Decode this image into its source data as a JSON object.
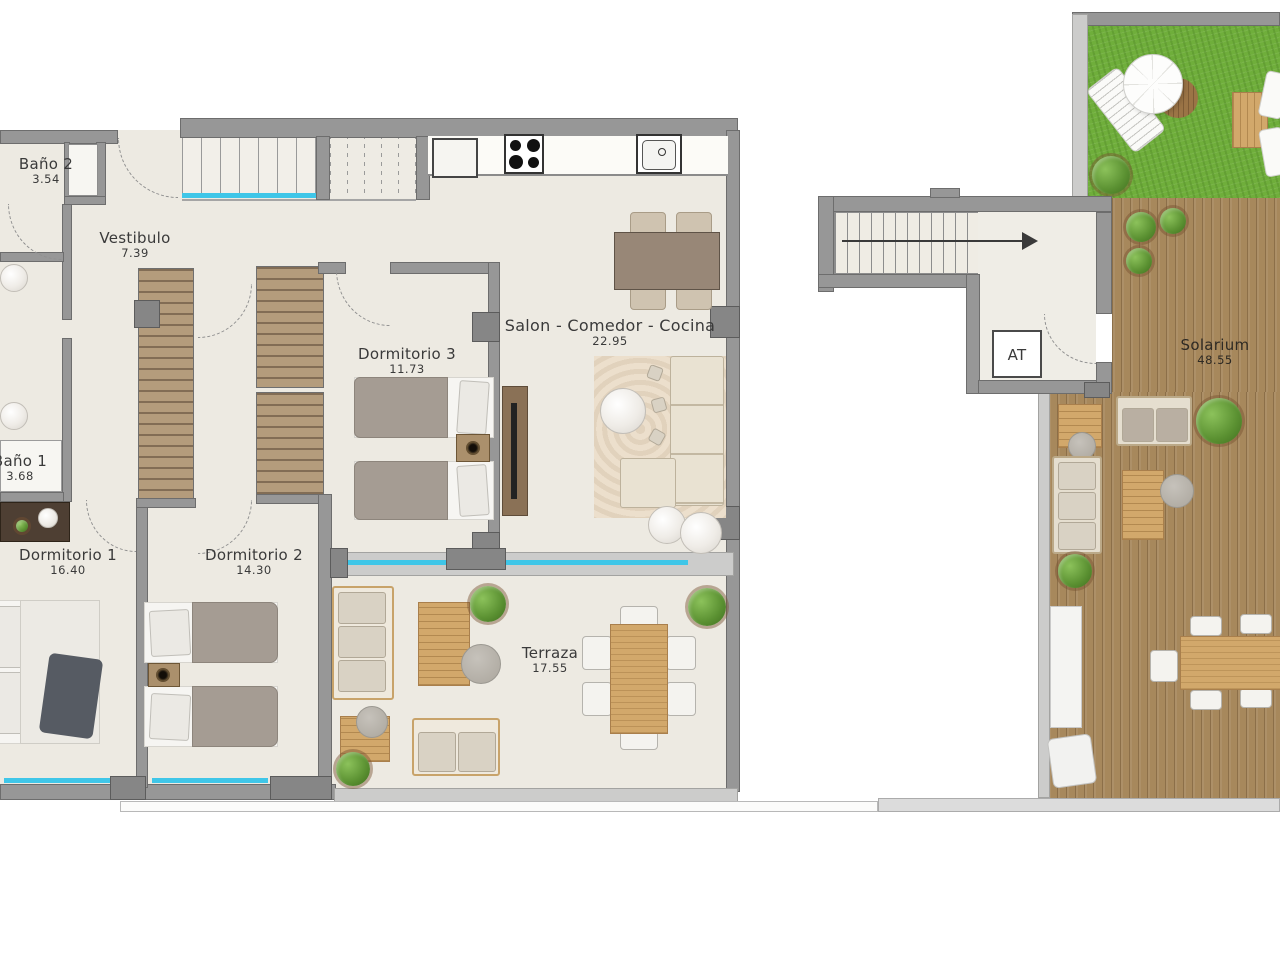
{
  "rooms": {
    "bano2": {
      "name": "Baño 2",
      "area": "3.54"
    },
    "vestibulo": {
      "name": "Vestibulo",
      "area": "7.39"
    },
    "dormitorio3": {
      "name": "Dormitorio 3",
      "area": "11.73"
    },
    "salon_comedor_cocina": {
      "name": "Salon - Comedor - Cocina",
      "area": "22.95"
    },
    "bano1": {
      "name": "Baño 1",
      "area": "3.68"
    },
    "dormitorio1": {
      "name": "Dormitorio 1",
      "area": "16.40"
    },
    "dormitorio2": {
      "name": "Dormitorio 2",
      "area": "14.30"
    },
    "terraza": {
      "name": "Terraza",
      "area": "17.55"
    },
    "solarium": {
      "name": "Solarium",
      "area": "48.55"
    },
    "trastero": {
      "name": "AT"
    }
  },
  "colors": {
    "wall_gray": "#979797",
    "floor_cream": "#edeae2",
    "deck_wood": "#a7885c",
    "grass_green": "#6fae3b",
    "window_cyan": "#3fc6e8",
    "furniture_wood": "#d2a86b"
  }
}
